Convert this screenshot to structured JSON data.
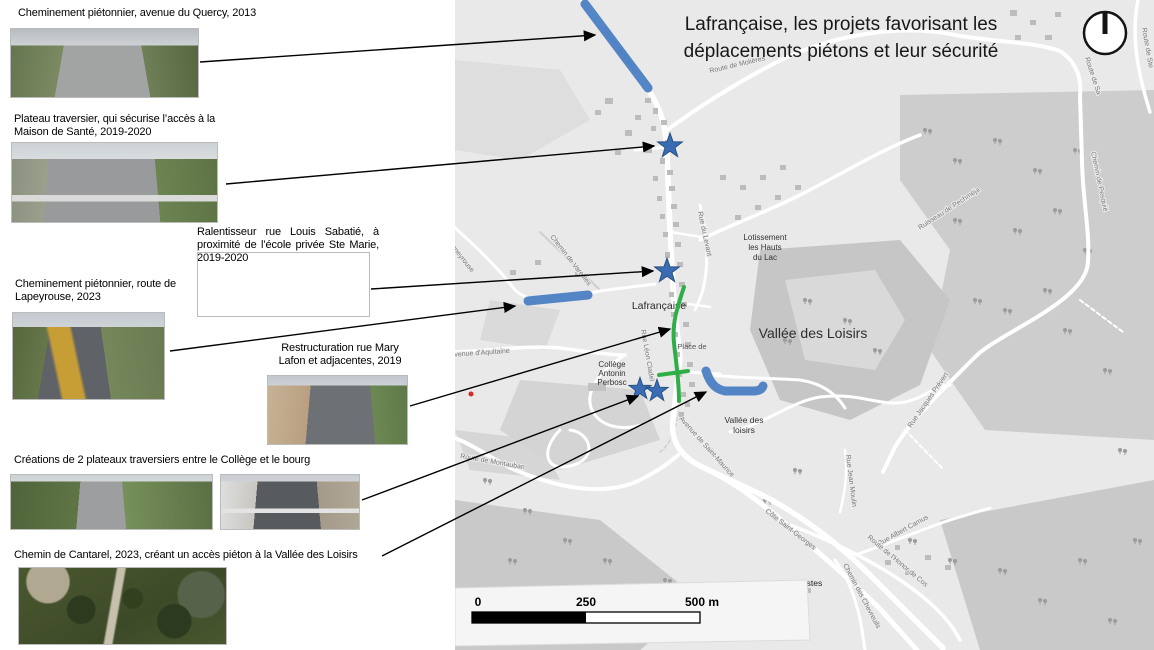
{
  "title": {
    "l1": "Lafrançaise, les projets favorisant les",
    "l2": "déplacements piétons et leur sécurité"
  },
  "annotations": [
    {
      "caption": "Cheminement piétonnier, avenue du Quercy, 2013"
    },
    {
      "caption": "Plateau traversier, qui sécurise l’accès à la Maison de Santé, 2019-2020"
    },
    {
      "caption": "Ralentisseur rue Louis Sabatié, à proximité de l’école privée Ste Marie, 2019-2020"
    },
    {
      "caption": "Cheminement piétonnier, route de Lapeyrouse, 2023"
    },
    {
      "caption": "Restructuration rue Mary Lafon et adjacentes, 2019"
    },
    {
      "caption": "Créations de 2 plateaux traversiers entre le Collège et le bourg"
    },
    {
      "caption": "Chemin de Cantarel, 2023, créant un accès piéton à la Vallée des Loisirs"
    }
  ],
  "map": {
    "areas": {
      "town": "Lafrançaise",
      "valleeBig": "Vallée des Loisirs",
      "vs1": "Vallée des",
      "vs2": "loisirs",
      "lot1": "Lotissement",
      "lot2": "les Hauts",
      "lot3": "du Lac",
      "col1": "Collège",
      "col2": "Antonin",
      "col3": "Perbosc",
      "lascostes": "Las Costes",
      "place": "Place de"
    },
    "street_labels": [
      "Avenue du Quercy",
      "Route de Molières",
      "Route de Sa",
      "Route de Ste",
      "Chemin de Pesquié",
      "Ruisseau de Pechméja",
      "Rue Jacques Prévert",
      "Rue Albert Camus",
      "Route de l'Honor de Cos",
      "Chemin des Chevreuils",
      "Côte Saint-Georges",
      "Avenue de Saint-Maurice",
      "Rue Jean Moulin",
      "Route de Montauban",
      "Avenue d'Aquitaine",
      "Chemin de Vareilles",
      "Route de Lapeyrouse",
      "Rue Léon Cladel",
      "Rue du Levant"
    ],
    "scale": {
      "t0": "0",
      "t1": "250",
      "t2": "500 m"
    },
    "colors": {
      "pedestrian_path_blue": "#4b80c4",
      "project_green": "#2fae47",
      "star_blue": "#3a6cb4",
      "marker_red": "#d42b1e"
    }
  }
}
